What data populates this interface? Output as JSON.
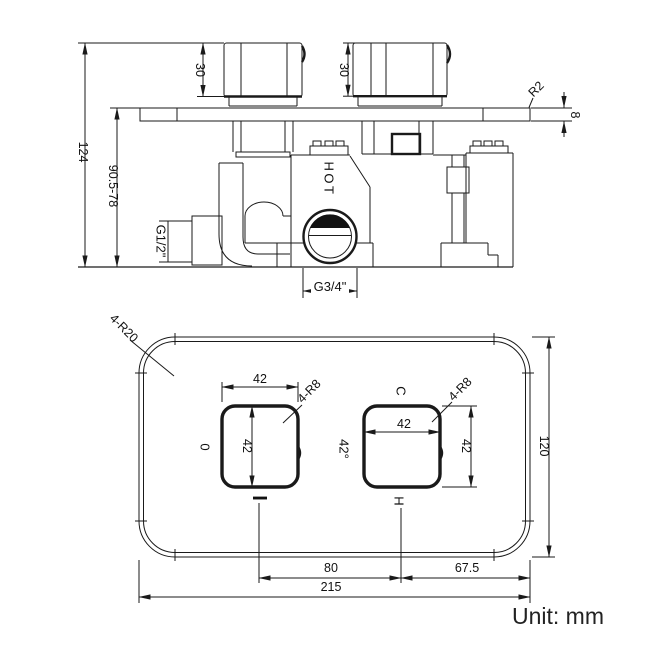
{
  "unit_note": "Unit: mm",
  "side_view": {
    "overall_height": "124",
    "adjust_range": "90.5-78",
    "handle_left_height": "30",
    "handle_right_height": "30",
    "plate_edge_radius": "R2",
    "plate_thickness": "8",
    "inlet_thread": "G1/2\"",
    "hot_label": "HOT",
    "outlet_thread": "G3/4\""
  },
  "front_view": {
    "plate_corner_radius": "4-R20",
    "plate_width": "215",
    "plate_height": "120",
    "center_spacing": "80",
    "edge_offset": "67.5",
    "left_handle": {
      "width": "42",
      "height": "42",
      "corner_radius": "4-R8",
      "off_label": "0",
      "on_label": "I"
    },
    "right_handle": {
      "width": "42",
      "height": "42",
      "corner_radius": "4-R8",
      "cold_label": "C",
      "temp_label": "42°",
      "hot_label": "H"
    }
  }
}
